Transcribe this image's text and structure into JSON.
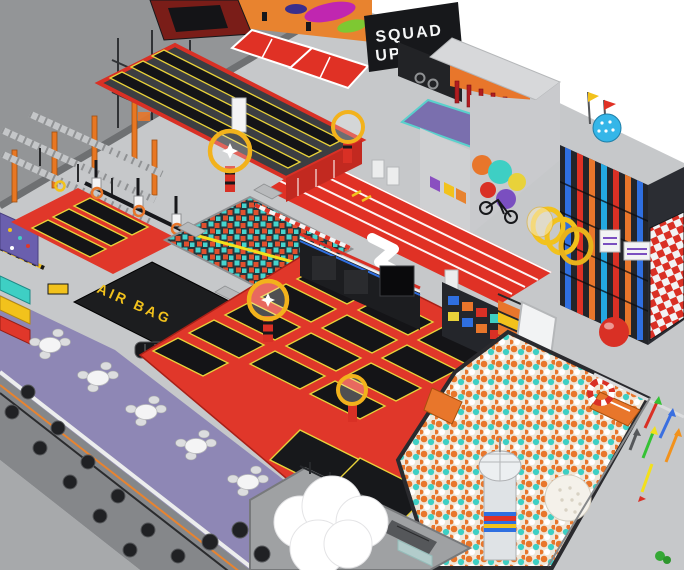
{
  "scene": {
    "type": "3d-render",
    "description": "Isometric interior render of an indoor trampoline park and family entertainment center",
    "signs": {
      "squad_up": {
        "line1": "SQUAD",
        "line2": "UP"
      },
      "air_bag": "AIR BAG"
    },
    "colors": {
      "background": "#ffffff",
      "floor": "#c6c8ca",
      "wall_top": "#939597",
      "wall_bottom": "#85878a",
      "banner_black": "#17181b",
      "banner_text": "#f5f6f7",
      "airbag_black": "#1c1d1f",
      "airbag_text": "#f2c21c",
      "pad_red": "#e0372a",
      "tramp_black": "#141417",
      "tramp_outline": "#e8d23a",
      "track_red": "#e03125",
      "cafe_purple": "#8e87b5",
      "foam_cyan": "#46d4ce",
      "foam_red": "#e0502e",
      "ball_orange": "#e8762b",
      "ball_cyan": "#3ecfc4",
      "ninja_orange": "#e87722",
      "dodgeball_orange": "#e8832f",
      "checker_red": "#d93025",
      "ring_yellow": "#f2b21c",
      "playground_dark": "#23252a",
      "slide_white": "#f2f3f4"
    },
    "zones": [
      "dodgeball-courts",
      "squad-up-banner",
      "performance-stage",
      "tumbling-tracks-deck",
      "ninja-course",
      "dunk-lanes",
      "foam-pit",
      "air-bag-pit",
      "trampoline-court",
      "sprint-track",
      "mural-building",
      "softplay-tower",
      "ball-pit",
      "cafe-seating",
      "arrow-walkway"
    ]
  }
}
